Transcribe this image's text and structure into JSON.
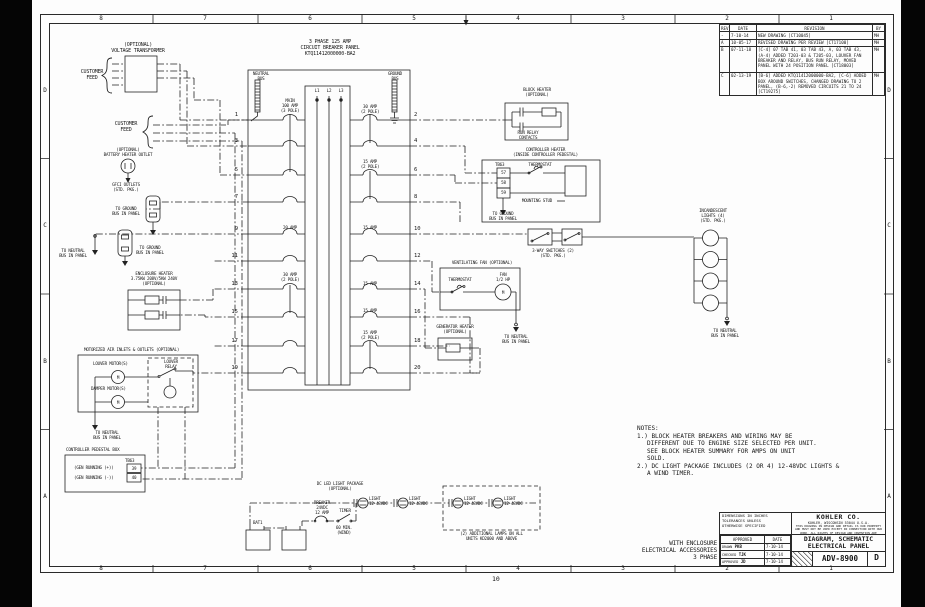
{
  "sheet": {
    "page_number": "10",
    "zones": {
      "columns": [
        "8",
        "7",
        "6",
        "5",
        "4",
        "3",
        "2",
        "1"
      ],
      "rows": [
        "D",
        "C",
        "B",
        "A"
      ]
    }
  },
  "feed": {
    "transformer": "(OPTIONAL)\nVOLTAGE TRANSFORMER",
    "customer1": "CUSTOMER\nFEED",
    "customer2": "CUSTOMER\nFEED"
  },
  "panel": {
    "title": "3 PHASE 125 AMP\nCIRCUIT BREAKER PANEL\nKTQ11412000000-BA2",
    "neutral_bus": "NEUTRAL\nBUS",
    "ground_bus": "GROUND\nBUS",
    "phases": [
      "L1",
      "L2",
      "L3"
    ],
    "circuits_left": [
      "1",
      "3",
      "5",
      "7",
      "9",
      "11",
      "13",
      "15",
      "17",
      "19"
    ],
    "circuits_right": [
      "2",
      "4",
      "6",
      "8",
      "10",
      "12",
      "14",
      "16",
      "18",
      "20"
    ],
    "breaker_labels": {
      "main": "MAIN\n100 AMP\n(3 POLE)",
      "c2": "30 AMP\n(2 POLE)",
      "c6": "15 AMP\n(2 POLE)",
      "c9": "20 AMP",
      "c10": "15 AMP",
      "c13": "30 AMP\n(2 POLE)",
      "c14": "15 AMP",
      "c16": "15 AMP",
      "c18": "15 AMP\n(2 POLE)"
    }
  },
  "left_components": {
    "battery_outlet": "(OPTIONAL)\nBATTERY HEATER OUTLET",
    "gfci": "GFCI OUTLETS\n(STD. PKG.)",
    "ground1": "TO GROUND\nBUS IN PANEL",
    "ground2": "TO GROUND\nBUS IN PANEL",
    "neutral": "TO NEUTRAL\nBUS IN PANEL",
    "enclosure_heater": "ENCLOSURE HEATER\n3.75KW 208V/5KW 240V\n(OPTIONAL)",
    "motorized_title": "MOTORIZED AIR INLETS & OUTLETS (OPTIONAL)",
    "louver_motors": "LOUVER MOTOR(S)",
    "damper_motors": "DAMPER MOTOR(S)",
    "motor_m": "M",
    "louver_relay": "LOUVER\nRELAY",
    "motorized_neutral": "TO NEUTRAL\nBUS IN PANEL",
    "pedestal": {
      "title": "CONTROLLER PEDESTAL BOX",
      "tb": "TB63",
      "rows": [
        {
          "label": "(GEN RUNNING (+))",
          "terminal": "39"
        },
        {
          "label": "(GEN RUNNING (-))",
          "terminal": "40"
        }
      ]
    }
  },
  "right_components": {
    "block_heater": {
      "title": "BLOCK HEATER\n(OPTIONAL)",
      "contacts": "RUN RELAY\nCONTACTS"
    },
    "controller_heater": {
      "title": "CONTROLLER HEATER\n(INSIDE CONTROLLER PEDESTAL)",
      "tb": "TB63",
      "terminals": [
        "57",
        "58",
        "59"
      ],
      "thermostat": "THERMOSTAT",
      "stud": "MOUNTING STUD",
      "ground": "TO GROUND\nBUS IN PANEL"
    },
    "switches": "3-WAY SWITCHES (2)\n(STD. PKG.)",
    "lights_title": "INCANDESCENT\nLIGHTS (4)\n(STD. PKG.)",
    "lights_neutral": "TO NEUTRAL\nBUS IN PANEL",
    "fan": {
      "title": "VENTILATING FAN (OPTIONAL)",
      "thermostat": "THERMOSTAT",
      "motor": "FAN\n1/2 HP",
      "m": "M",
      "neutral": "TO NEUTRAL\nBUS IN PANEL"
    },
    "gen_heater": "GENERATOR HEATER\n(OPTIONAL)"
  },
  "dc_package": {
    "title": "DC LED LIGHT PACKAGE\n(OPTIONAL)",
    "battery": "BAT1",
    "breaker": "BREAKER\n24VDC\n12 AMP",
    "timer": "TIMER",
    "timer_duration": "60 MIN.\n(WIND)",
    "lights": [
      "LIGHT\n12-48VDC",
      "LIGHT\n12-48VDC",
      "LIGHT\n12-48VDC",
      "LIGHT\n12-48VDC"
    ],
    "additional": "(2) ADDITIONAL LAMPS ON ALL\nUNITS KD2000 AND ABOVE"
  },
  "notes": {
    "title": "NOTES:",
    "items": [
      "1.) BLOCK HEATER BREAKERS AND WIRING MAY BE\nDIFFERENT DUE TO ENGINE SIZE SELECTED PER UNIT.\nSEE BLOCK HEATER SUMMARY FOR AMPS ON UNIT\nSOLD.",
      "2.) DC LIGHT PACKAGE INCLUDES (2 OR 4) 12-48VDC LIGHTS &\nA WIND TIMER."
    ]
  },
  "revision_table": {
    "headers": [
      "REV",
      "DATE",
      "REVISION",
      "BY"
    ],
    "rows": [
      [
        "-",
        "7-10-14",
        "NEW DRAWING [CT10045]",
        "MH"
      ],
      [
        "A",
        "10-05-17",
        "REVISED DRAWING PER REVIEW [CT17100]",
        "MH"
      ],
      [
        "B",
        "07-11-18",
        "[C-4] 07 TAB 41, 03 TAB 43, A, 03 TAB 43, (A-4) ADDED T203-03 & T205-03, LOUVER FAN BREAKER AND RELAY, BUS RUN RELAY, MOVED PANEL WITH 24 POSITION PANEL [CT18003]",
        "MH"
      ],
      [
        "C",
        "02-13-19",
        "[B-6] ADDED KTQ11412000000-BA2, [C-6] ADDED BOX AROUND SWITCHES, CHANGED DRAWING TO 2 PANEL, (B-6,-2) REMOVED CIRCUITS 21 TO 24 [CT19275]",
        "MH"
      ]
    ]
  },
  "title_block": {
    "tolerances": "DIMENSIONS IN INCHES\nTOLERANCES UNLESS\nOTHERWISE SPECIFIED",
    "approvals": {
      "headers": [
        "APPROVED",
        "DATE"
      ],
      "rows": [
        [
          "DRAWN",
          "PKB",
          "7-10-14"
        ],
        [
          "CHECKED",
          "TJK",
          "7-10-14"
        ],
        [
          "APPROVED",
          "JD",
          "7-10-14"
        ]
      ]
    },
    "company": "KOHLER CO.",
    "company_address": "KOHLER, WISCONSIN 53044 U.S.A.",
    "proprietary": "THIS DRAWING IN DESIGN AND DETAIL IS OUR PROPERTY AND MUST NOT BE USED EXCEPT IN CONNECTION WITH OUR WORK. ALL RIGHTS OF DESIGN AND INVENTION ARE RESERVED.",
    "title": "DIAGRAM, SCHEMATIC\nELECTRICAL PANEL",
    "drawing_number": "ADV-8900",
    "revision": "D"
  },
  "footer": {
    "variant": "WITH ENCLOSURE\nELECTRICAL ACCESSORIES\n3 PHASE"
  }
}
